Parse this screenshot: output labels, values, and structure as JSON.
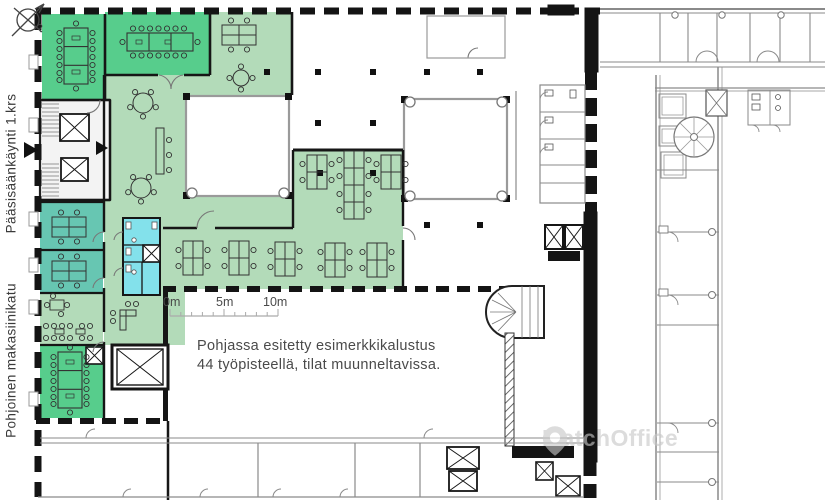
{
  "labels": {
    "main_entrance": "Pääsisäänkäynti 1.krs",
    "street": "Pohjoinen makasiinikatu"
  },
  "compass": {
    "label": "P"
  },
  "scale_bar": {
    "ticks": [
      "0m",
      "5m",
      "10m"
    ]
  },
  "annotation": {
    "line1": "Pohjassa esitetty esimerkkikalustus",
    "line2": "44 työpisteellä, tilat muunneltavissa."
  },
  "watermark": {
    "brand": "MatchOffice",
    "icon": "map-pin-icon"
  },
  "colors": {
    "meeting_green": "#57cd8c",
    "open_green": "#b3dbb9",
    "office_teal": "#67c6b2",
    "wc_cyan": "#83e1eb",
    "wall_black": "#141414",
    "line_gray": "#8a8a8a",
    "core_gray": "#f3f3f3",
    "text_dark": "#4a4a4a",
    "watermark_gray": "#c7c7c7"
  }
}
